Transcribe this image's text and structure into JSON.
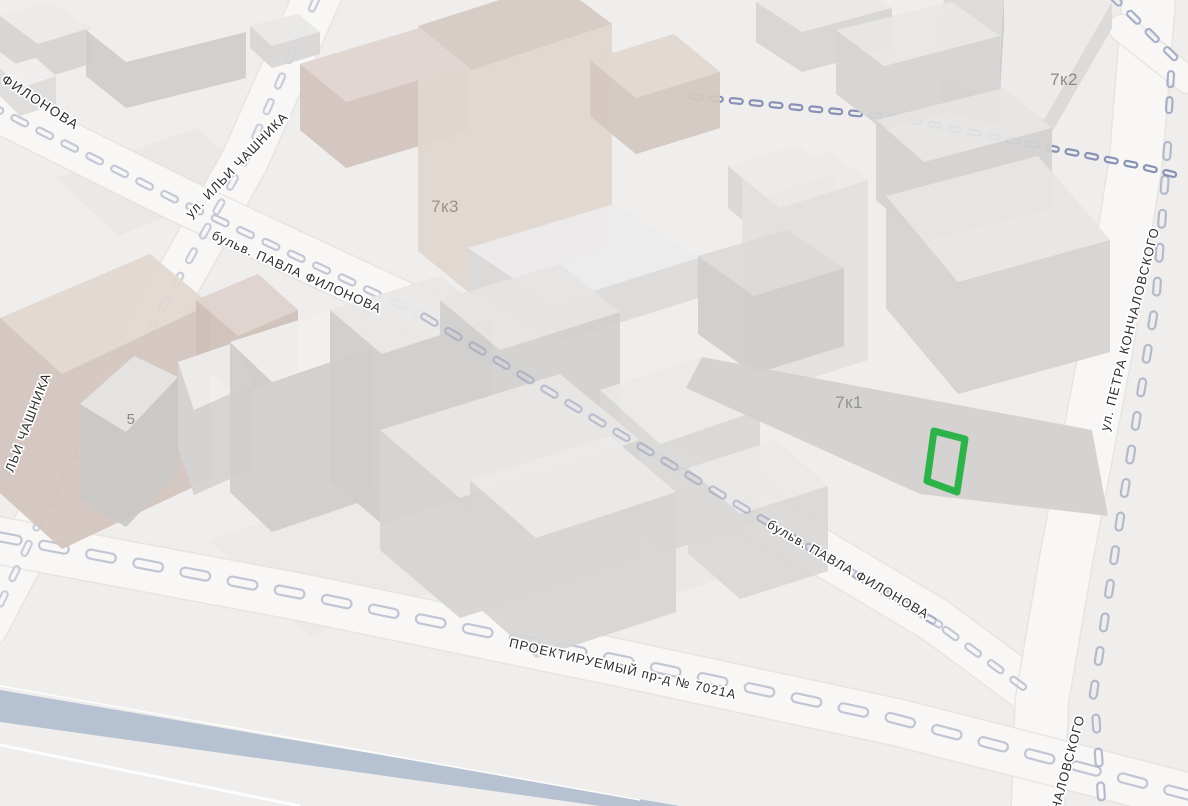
{
  "canvas": {
    "width": 1188,
    "height": 806,
    "background": "#f0eeec"
  },
  "palette": {
    "road_fill": "#f8f7f6",
    "road_edge": "#e4e2e0",
    "dash_blue": "#a8b1c6",
    "marker_green": "#2eb34a",
    "blue_band": "#b6c1d2",
    "street_label_color": "#2e2e2e",
    "building_label_color": "#918f8d",
    "halo": "#ffffff"
  },
  "street_labels": [
    {
      "text": "ФИЛОНОВА",
      "x": 38,
      "y": 106,
      "rotate": 33,
      "size": 13.5,
      "ls": 1.5
    },
    {
      "text": "ул. ИЛЬИ ЧАШНИКА",
      "x": 240,
      "y": 168,
      "rotate": -46,
      "size": 13,
      "ls": 1
    },
    {
      "text": "бульв. ПАВЛА ФИЛОНОВА",
      "x": 295,
      "y": 276,
      "rotate": 24,
      "size": 13,
      "ls": 1
    },
    {
      "text": "ЛЬИ ЧАШНИКА",
      "x": 32,
      "y": 424,
      "rotate": -69,
      "size": 13,
      "ls": 1
    },
    {
      "text": "бульв. ПАВЛА ФИЛОНОВА",
      "x": 846,
      "y": 573,
      "rotate": 30,
      "size": 13,
      "ls": 1
    },
    {
      "text": "ул. ПЕТРА КОНЧАЛОВСКОГО",
      "x": 1134,
      "y": 330,
      "rotate": -76,
      "size": 13,
      "ls": 1.2
    },
    {
      "text": "ПРОЕКТИРУЕМЫЙ пр-д № 7021А",
      "x": 622,
      "y": 673,
      "rotate": 13,
      "size": 13,
      "ls": 1
    },
    {
      "text": "НАЛОВСКОГО",
      "x": 1072,
      "y": 764,
      "rotate": -75,
      "size": 13,
      "ls": 1
    }
  ],
  "building_labels": [
    {
      "text": "7к2",
      "x": 1064,
      "y": 85,
      "size": 17,
      "color": "#8c8a88"
    },
    {
      "text": "7к3",
      "x": 445,
      "y": 212,
      "size": 17,
      "color": "#9b918c"
    },
    {
      "text": "7к1",
      "x": 849,
      "y": 408,
      "size": 17,
      "color": "#949392"
    },
    {
      "text": "5",
      "x": 131,
      "y": 424,
      "size": 15,
      "color": "#8a8886"
    }
  ],
  "roads": [
    {
      "name": "ilyi-chashnika",
      "d": "M 320 -10 L 245 160 L 150 330 L 40 520 L -15 625",
      "w": 46
    },
    {
      "name": "pavla-filonova",
      "d": "M -25 98 L 180 200 L 420 312 L 700 480 L 935 620 L 1032 692 C 1042 720 1044 760 1040 806",
      "w": 44
    },
    {
      "name": "petra-konchalovskogo",
      "d": "M 1150 -15 L 1136 160 L 1106 350 L 1066 560 L 1042 700 L 1038 806",
      "w": 52
    },
    {
      "name": "proektiruemy-7021a",
      "d": "M -15 538 L 300 597 L 620 663 L 900 723 L 1190 797",
      "w": 46
    },
    {
      "name": "corner-connector",
      "d": "M 1122 28 L 1188 80",
      "w": 26
    }
  ],
  "dash_lines": [
    {
      "name": "filonova-dashes",
      "pts": [
        [
          -15,
          103
        ],
        [
          180,
          202
        ],
        [
          420,
          314
        ],
        [
          700,
          482
        ],
        [
          935,
          622
        ],
        [
          1030,
          692
        ]
      ],
      "dw": 18,
      "dh": 6,
      "gap": 10,
      "color": "#b6bdcf",
      "opacity": 0.8,
      "above": false
    },
    {
      "name": "chashnika-dashes",
      "pts": [
        [
          318,
          -5
        ],
        [
          245,
          160
        ],
        [
          150,
          330
        ],
        [
          40,
          520
        ],
        [
          -5,
          615
        ]
      ],
      "dw": 16,
      "dh": 6,
      "gap": 12,
      "color": "#b9c0d0",
      "opacity": 0.75,
      "above": false
    },
    {
      "name": "proektiruemy-dashes",
      "pts": [
        [
          -10,
          535
        ],
        [
          300,
          594
        ],
        [
          620,
          660
        ],
        [
          900,
          720
        ],
        [
          1188,
          795
        ]
      ],
      "dw": 30,
      "dh": 9,
      "gap": 18,
      "color": "#b4bbcc",
      "opacity": 0.8,
      "above": false
    },
    {
      "name": "konchalovskogo-dashes",
      "pts": [
        [
          1168,
          140
        ],
        [
          1156,
          300
        ],
        [
          1120,
          520
        ],
        [
          1094,
          690
        ],
        [
          1102,
          806
        ]
      ],
      "dw": 18,
      "dh": 7,
      "gap": 16,
      "color": "#a8b1c6",
      "opacity": 0.85,
      "above": false
    },
    {
      "name": "rail-crossing-dashes",
      "pts": [
        [
          688,
          96
        ],
        [
          900,
          118
        ],
        [
          1135,
          165
        ],
        [
          1188,
          178
        ]
      ],
      "dw": 13,
      "dh": 5,
      "gap": 7,
      "color": "#7b88b0",
      "opacity": 0.9,
      "above": false
    },
    {
      "name": "corner-dashes",
      "pts": [
        [
          1108,
          -8
        ],
        [
          1172,
          55
        ],
        [
          1168,
          130
        ]
      ],
      "dw": 16,
      "dh": 6,
      "gap": 10,
      "color": "#9aa5c2",
      "opacity": 0.85,
      "above": false
    },
    {
      "name": "filonova-dashes-over",
      "pts": [
        [
          420,
          314
        ],
        [
          700,
          482
        ],
        [
          935,
          622
        ]
      ],
      "dw": 18,
      "dh": 6,
      "gap": 10,
      "color": "#8d97ba",
      "opacity": 0.5,
      "above": true
    }
  ],
  "ground_patches": [
    {
      "pts": [
        [
          56,
          178
        ],
        [
          196,
          128
        ],
        [
          258,
          180
        ],
        [
          118,
          236
        ]
      ],
      "color": "#e7e5e3",
      "opacity": 0.6
    },
    {
      "pts": [
        [
          600,
          520
        ],
        [
          760,
          468
        ],
        [
          830,
          540
        ],
        [
          670,
          596
        ]
      ],
      "color": "#e5e3e1",
      "opacity": 0.5
    },
    {
      "pts": [
        [
          210,
          540
        ],
        [
          420,
          470
        ],
        [
          520,
          560
        ],
        [
          310,
          636
        ]
      ],
      "color": "#e8e6e4",
      "opacity": 0.5
    }
  ],
  "buildings": [
    {
      "top": [
        [
          0,
          16
        ],
        [
          52,
          2
        ],
        [
          90,
          28
        ],
        [
          38,
          44
        ]
      ],
      "h": 36,
      "tc": "#ecebea",
      "sc": "#d6d5d4"
    },
    {
      "top": [
        [
          86,
          30
        ],
        [
          206,
          2
        ],
        [
          246,
          32
        ],
        [
          126,
          62
        ]
      ],
      "h": 46,
      "tc": "#f0efee",
      "sc": "#cfcecd"
    },
    {
      "top": [
        [
          250,
          26
        ],
        [
          298,
          14
        ],
        [
          320,
          32
        ],
        [
          272,
          46
        ]
      ],
      "h": 22,
      "tc": "#eae9e8",
      "sc": "#d8d7d6"
    },
    {
      "top": [
        [
          0,
          68
        ],
        [
          36,
          58
        ],
        [
          56,
          76
        ],
        [
          20,
          88
        ]
      ],
      "h": 28,
      "tc": "#f1f0ef",
      "sc": "#dedddc"
    },
    {
      "top": [
        [
          756,
          2
        ],
        [
          846,
          -20
        ],
        [
          892,
          8
        ],
        [
          802,
          32
        ]
      ],
      "h": 40,
      "tc": "#eae9e8",
      "sc": "#d7d6d5"
    },
    {
      "top": [
        [
          944,
          -10
        ],
        [
          1004,
          -4
        ],
        [
          998,
          96
        ],
        [
          942,
          80
        ]
      ],
      "h": 30,
      "tc": "#dcdbda",
      "sc": "#cccbca"
    },
    {
      "top": [
        [
          1006,
          -6
        ],
        [
          1112,
          2
        ],
        [
          1044,
          120
        ],
        [
          1000,
          98
        ]
      ],
      "h": 26,
      "tc": "#ecebea",
      "sc": "#dbdad9"
    },
    {
      "top": [
        [
          836,
          30
        ],
        [
          952,
          2
        ],
        [
          1000,
          36
        ],
        [
          884,
          66
        ]
      ],
      "h": 64,
      "tc": "#e9e8e7",
      "sc": "#d6d5d4"
    },
    {
      "top": [
        [
          876,
          120
        ],
        [
          1004,
          88
        ],
        [
          1052,
          128
        ],
        [
          924,
          162
        ]
      ],
      "h": 80,
      "tc": "#e7e6e5",
      "sc": "#d4d3d2"
    },
    {
      "top": [
        [
          728,
          166
        ],
        [
          798,
          146
        ],
        [
          834,
          174
        ],
        [
          764,
          196
        ]
      ],
      "h": 42,
      "tc": "#ecebea",
      "sc": "#d9d8d7"
    },
    {
      "top": [
        [
          300,
          64
        ],
        [
          420,
          28
        ],
        [
          466,
          66
        ],
        [
          346,
          102
        ]
      ],
      "h": 66,
      "tc": "#e0d5cf",
      "sc": "#d2c4bd"
    },
    {
      "top": [
        [
          418,
          26
        ],
        [
          556,
          -18
        ],
        [
          612,
          24
        ],
        [
          472,
          70
        ]
      ],
      "h": 225,
      "tc": "#d7cac4",
      "sc": "#e2d7d1"
    },
    {
      "top": [
        [
          590,
          60
        ],
        [
          674,
          34
        ],
        [
          720,
          72
        ],
        [
          636,
          98
        ]
      ],
      "h": 56,
      "tc": "#e2d8d2",
      "sc": "#d5c8c1"
    },
    {
      "top": [
        [
          468,
          248
        ],
        [
          614,
          204
        ],
        [
          698,
          258
        ],
        [
          552,
          304
        ]
      ],
      "h": 40,
      "tc": "#edecec",
      "sc": "#dcdbda"
    },
    {
      "top": [
        [
          0,
          318
        ],
        [
          150,
          254
        ],
        [
          210,
          304
        ],
        [
          62,
          374
        ]
      ],
      "h": 175,
      "tc": "#e3d8d2",
      "sc": "#d4c6bf"
    },
    {
      "top": [
        [
          196,
          300
        ],
        [
          258,
          274
        ],
        [
          298,
          310
        ],
        [
          238,
          336
        ]
      ],
      "h": 60,
      "tc": "#ded3cd",
      "sc": "#cfc1ba"
    },
    {
      "top": [
        [
          80,
          404
        ],
        [
          134,
          356
        ],
        [
          178,
          377
        ],
        [
          126,
          432
        ]
      ],
      "h": 95,
      "tc": "#e7e6e5",
      "sc": "#cbcac9"
    },
    {
      "top": [
        [
          178,
          362
        ],
        [
          236,
          342
        ],
        [
          252,
          384
        ],
        [
          194,
          410
        ]
      ],
      "h": 85,
      "tc": "#efeeed",
      "sc": "#d5d4d3"
    },
    {
      "top": [
        [
          230,
          342
        ],
        [
          330,
          310
        ],
        [
          372,
          348
        ],
        [
          272,
          382
        ]
      ],
      "h": 150,
      "tc": "#f2f1f0",
      "sc": "#d0cfce"
    },
    {
      "top": [
        [
          330,
          310
        ],
        [
          440,
          276
        ],
        [
          492,
          318
        ],
        [
          382,
          354
        ]
      ],
      "h": 170,
      "tc": "#e9e8e7",
      "sc": "#cfcecd"
    },
    {
      "top": [
        [
          440,
          300
        ],
        [
          560,
          264
        ],
        [
          620,
          312
        ],
        [
          500,
          350
        ]
      ],
      "h": 190,
      "tc": "#e6e5e4",
      "sc": "#d2d1d0"
    },
    {
      "top": [
        [
          600,
          390
        ],
        [
          700,
          358
        ],
        [
          760,
          410
        ],
        [
          660,
          444
        ]
      ],
      "h": 110,
      "tc": "#ebeae9",
      "sc": "#d9d8d7"
    },
    {
      "top": [
        [
          380,
          430
        ],
        [
          560,
          374
        ],
        [
          640,
          440
        ],
        [
          460,
          498
        ]
      ],
      "h": 120,
      "tc": "#e9e8e7",
      "sc": "#d6d5d4"
    },
    {
      "top": [
        [
          470,
          480
        ],
        [
          610,
          436
        ],
        [
          676,
          492
        ],
        [
          536,
          538
        ]
      ],
      "h": 120,
      "tc": "#ecebea",
      "sc": "#d7d6d5"
    },
    {
      "top": [
        [
          688,
          468
        ],
        [
          776,
          440
        ],
        [
          828,
          486
        ],
        [
          740,
          514
        ]
      ],
      "h": 85,
      "tc": "#ebeae9",
      "sc": "#dad9d8"
    },
    {
      "top": [
        [
          742,
          178
        ],
        [
          830,
          152
        ],
        [
          868,
          180
        ],
        [
          780,
          208
        ]
      ],
      "h": 180,
      "tc": "#ecebea",
      "sc": "#e3e2e1"
    },
    {
      "top": [
        [
          698,
          256
        ],
        [
          788,
          230
        ],
        [
          844,
          268
        ],
        [
          754,
          296
        ]
      ],
      "h": 78,
      "tc": "#dcdbda",
      "sc": "#cfcecd"
    },
    {
      "top": [
        [
          886,
          196
        ],
        [
          1038,
          156
        ],
        [
          1110,
          240
        ],
        [
          958,
          282
        ]
      ],
      "h": 112,
      "tc": "#e8e7e6",
      "sc": "#d5d4d3"
    }
  ],
  "podium_7k1": {
    "pts": [
      [
        702,
        357
      ],
      [
        1092,
        430
      ],
      [
        1108,
        516
      ],
      [
        920,
        494
      ],
      [
        686,
        388
      ]
    ],
    "color": "#d2d1d0",
    "opacity": 0.95
  },
  "blue_band": {
    "pts": [
      [
        0,
        690
      ],
      [
        0,
        722
      ],
      [
        600,
        806
      ],
      [
        680,
        806
      ]
    ],
    "color": "#b6c1d2"
  },
  "white_lines": [
    {
      "x1": 0,
      "y1": 745,
      "x2": 300,
      "y2": 806,
      "w": 3
    },
    {
      "x1": 0,
      "y1": 686,
      "x2": 640,
      "y2": 800,
      "w": 1.5
    }
  ],
  "marker": {
    "pts": [
      [
        934,
        431
      ],
      [
        965,
        439
      ],
      [
        957,
        492
      ],
      [
        927,
        481
      ]
    ],
    "color": "#2eb34a",
    "stroke_width": 7
  }
}
